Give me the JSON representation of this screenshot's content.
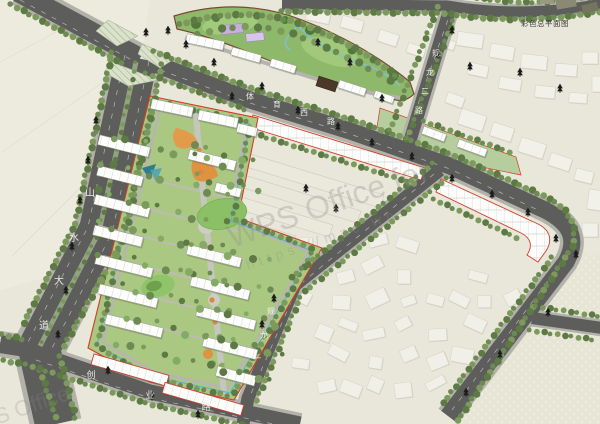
{
  "title": "彩色总平面图",
  "watermark": {
    "line1": "WPS Office for",
    "line2": "https://mac.wps",
    "line3": "WPS Office"
  },
  "roads": {
    "shanshui_avenue": {
      "name": "山水大道",
      "chars": [
        "山",
        "水",
        "大",
        "道"
      ]
    },
    "tiyu_west_road": {
      "name": "体育西路",
      "chars": [
        "体",
        "育",
        "西",
        "路"
      ]
    },
    "guilong_2nd_road": {
      "name": "规龙二路",
      "chars": [
        "规",
        "龙",
        "二",
        "路"
      ]
    },
    "guilong_1st_road": {
      "name": "规龙一路",
      "chars": [
        "规",
        "龙",
        "一",
        "路"
      ]
    },
    "chuangye_road": {
      "name": "创业路",
      "chars": [
        "创",
        "业",
        "路"
      ]
    }
  },
  "colors": {
    "background": "#e9e7da",
    "road": "#5d5d5b",
    "sidewalk": "#b2b2aa",
    "median_green": "#93a281",
    "parcel_green": "#abc883",
    "lawn": "#8cc066",
    "tree_dark": "#5e7a44",
    "tree_mid": "#6d8a52",
    "tree_light": "#7b9a5c",
    "building_white": "#fdfdfb",
    "existing_building": "#f2f1e9",
    "boundary_red": "#d23b28",
    "boundary_brown": "#7a4a30",
    "water_blue": "#58aede",
    "plaza_orange": "#df9240",
    "lavender": "#c7aede",
    "watermark_gray": "#8c8c8c"
  }
}
